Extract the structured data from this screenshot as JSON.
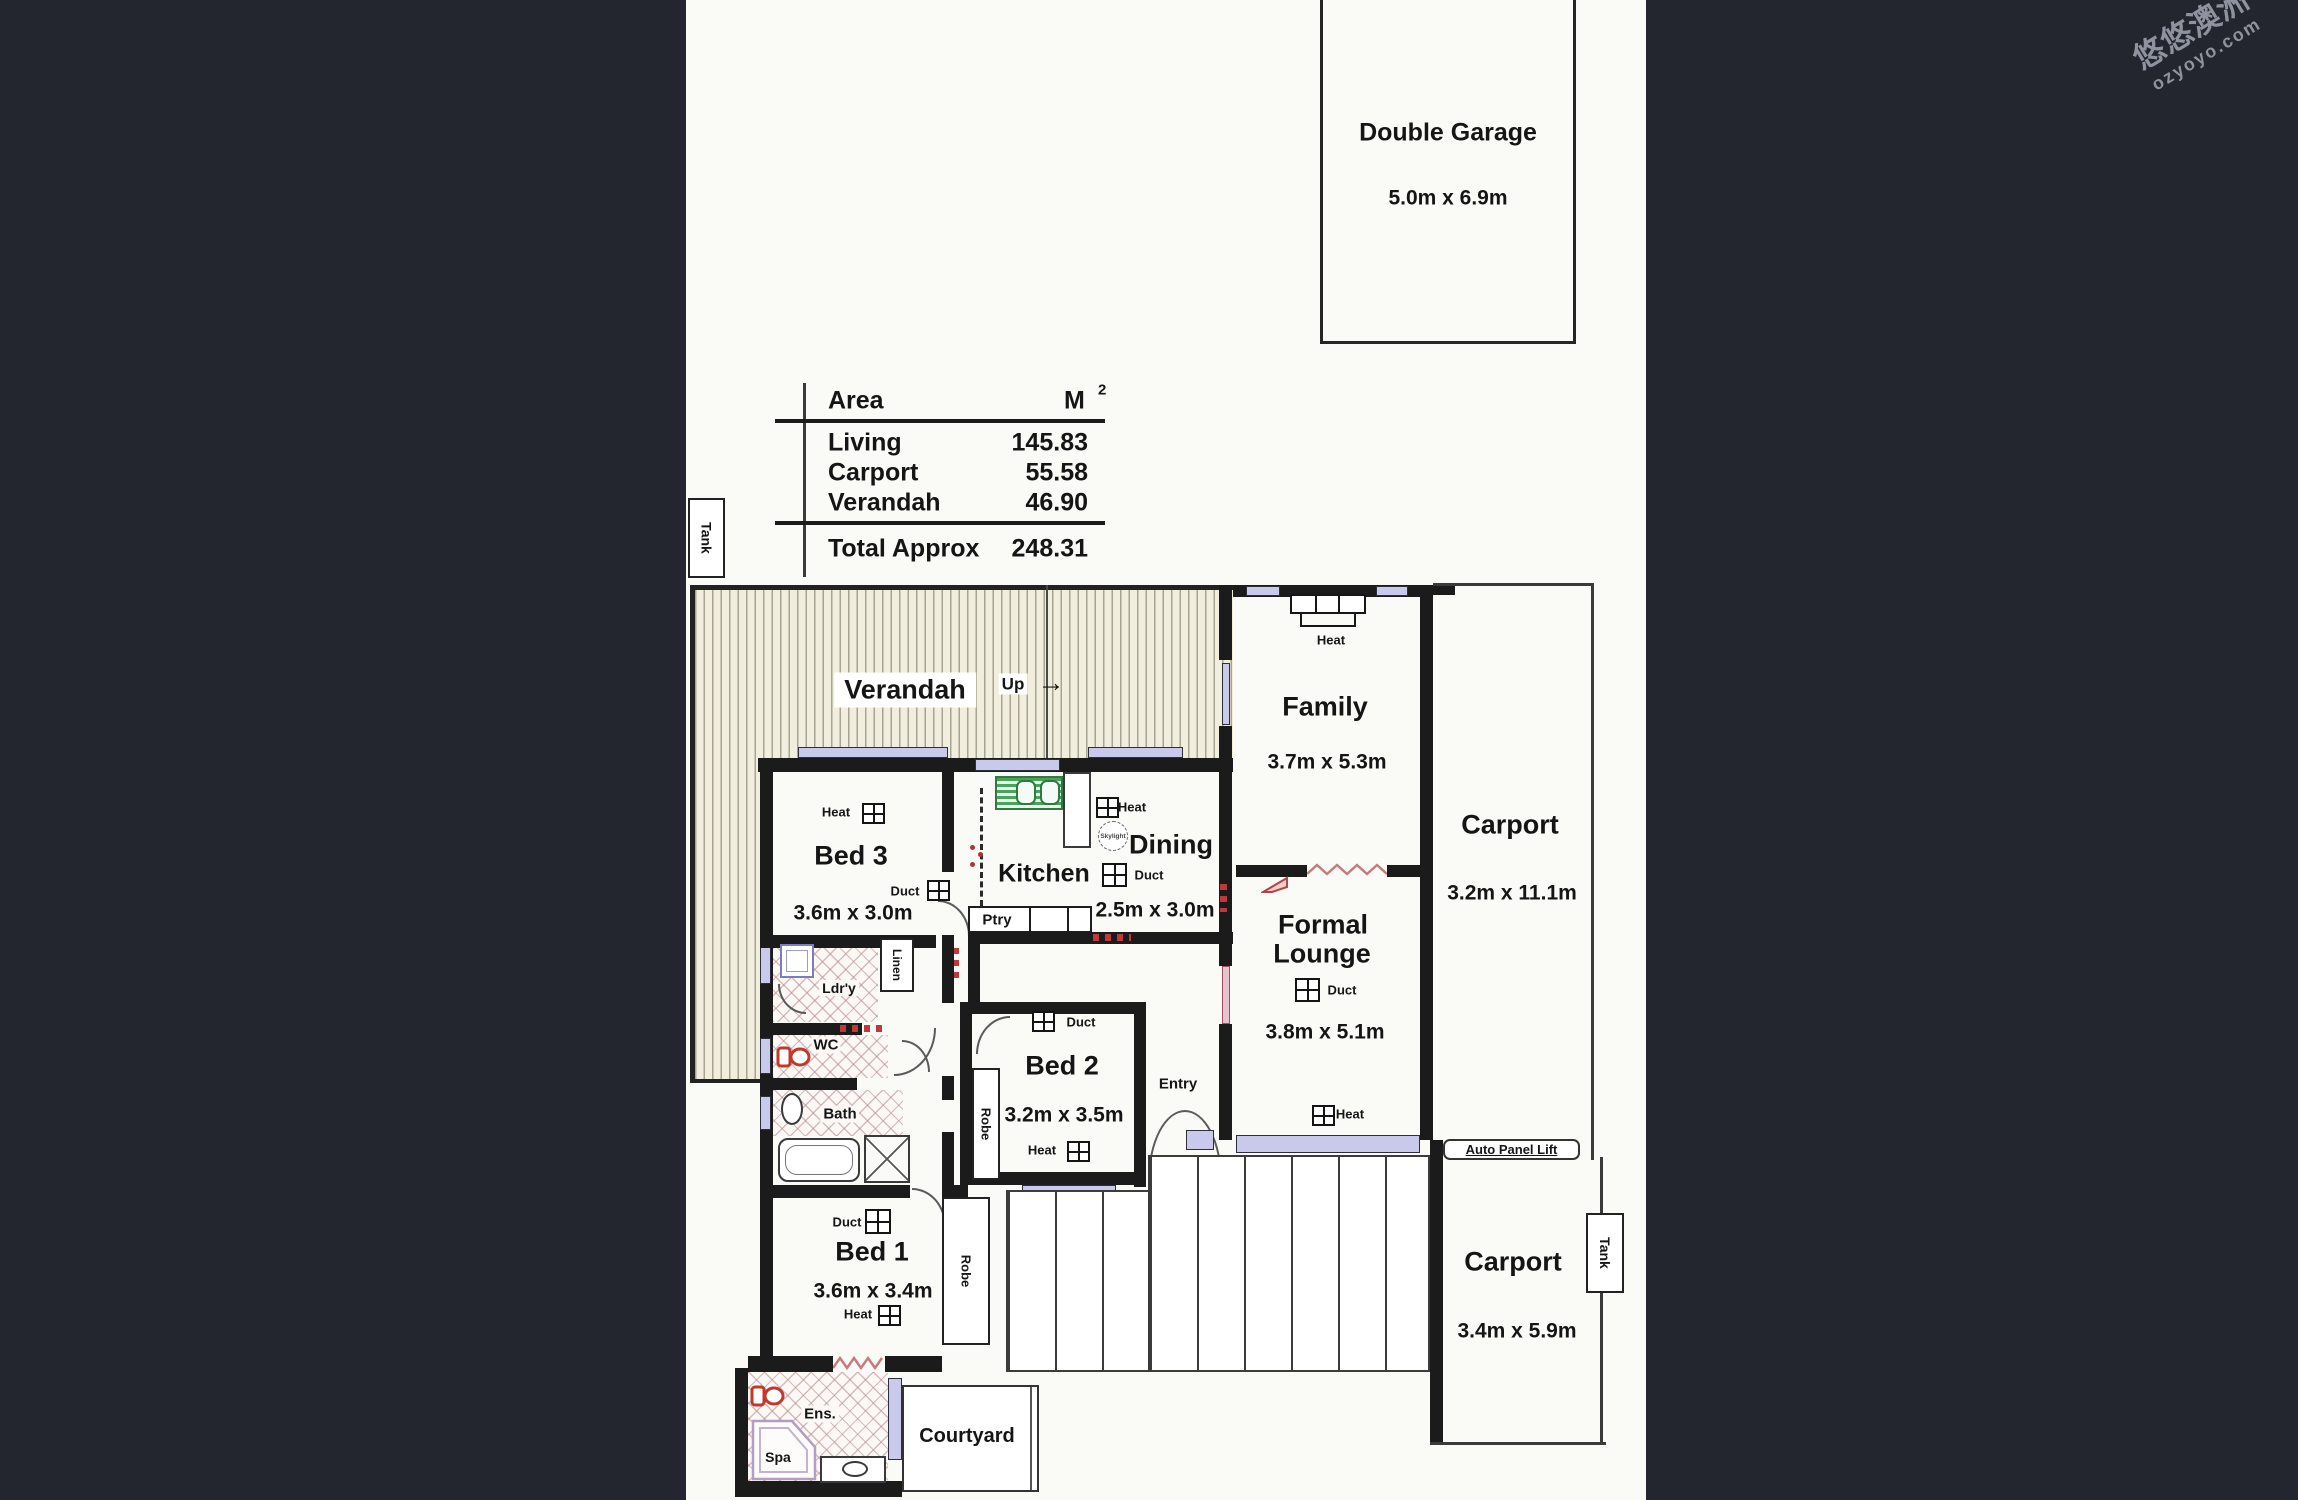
{
  "watermark": {
    "brand": "悠悠澳洲",
    "site": "ozyoyo.com"
  },
  "garage": {
    "name": "Double Garage",
    "dims": "5.0m x 6.9m"
  },
  "area_table": {
    "col_area": "Area",
    "col_unit": "M",
    "col_unit_sup": "2",
    "rows": [
      {
        "label": "Living",
        "value": "145.83"
      },
      {
        "label": "Carport",
        "value": "55.58"
      },
      {
        "label": "Verandah",
        "value": "46.90"
      }
    ],
    "total_label": "Total Approx",
    "total_value": "248.31"
  },
  "tank_left": "Tank",
  "tank_right": "Tank",
  "verandah": {
    "label": "Verandah",
    "up": "Up",
    "arrow": "→"
  },
  "rooms": {
    "family": {
      "name": "Family",
      "dims": "3.7m x 5.3m"
    },
    "dining": {
      "name": "Dining",
      "dims": "2.5m x 3.0m"
    },
    "kitchen": {
      "name": "Kitchen"
    },
    "bed3": {
      "name": "Bed 3",
      "dims": "3.6m x 3.0m"
    },
    "bed2": {
      "name": "Bed 2",
      "dims": "3.2m x 3.5m"
    },
    "bed1": {
      "name": "Bed 1",
      "dims": "3.6m x 3.4m"
    },
    "lounge": {
      "name_line1": "Formal",
      "name_line2": "Lounge",
      "dims": "3.8m x 5.1m"
    },
    "carport_side": {
      "name": "Carport",
      "dims": "3.2m x 11.1m"
    },
    "carport_rear": {
      "name": "Carport",
      "dims": "3.4m x 5.9m"
    },
    "courtyard": {
      "name": "Courtyard"
    }
  },
  "fixtures": {
    "heat": "Heat",
    "duct": "Duct",
    "skylight": "Skylight",
    "ptry": "Ptry",
    "linen": "Linen",
    "ldry": "Ldr'y",
    "wc": "WC",
    "bath": "Bath",
    "robe": "Robe",
    "entry": "Entry",
    "ens": "Ens.",
    "spa": "Spa",
    "auto_panel_lift": "Auto Panel Lift"
  },
  "colors": {
    "paper": "#fafaf7",
    "backdrop": "#23262e",
    "wall": "#1b1b1b",
    "window": "#c9c9ec",
    "verandah_fill": "#f1eedd",
    "accent_red": "#c03838",
    "sink_green": "#3f9b55",
    "watermark_gray": "#8e939f"
  }
}
